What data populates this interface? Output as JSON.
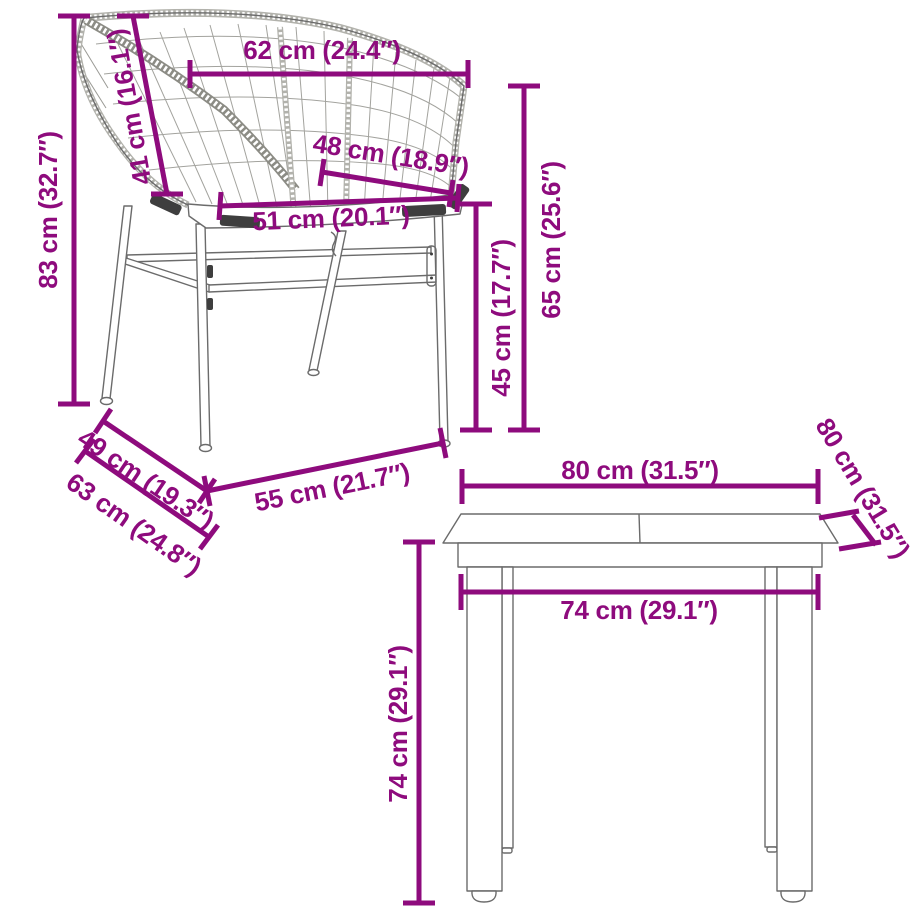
{
  "title": "Garden furniture set dimensions diagram",
  "colors": {
    "dimension": "#8e0b7d",
    "lineart": "#6b6b6b",
    "background": "#ffffff"
  },
  "chair": {
    "name": "garden chair with rattan backrest",
    "dims": {
      "height": "83 cm (32.7″)",
      "back_width": "62 cm (24.4″)",
      "backrest_height": "41 cm (16.1″)",
      "seat_depth": "48 cm (18.9″)",
      "seat_width": "51 cm (20.1″)",
      "armrest_height": "65 cm (25.6″)",
      "seat_height": "45 cm (17.7″)",
      "base_depth": "49 cm (19.3″)",
      "total_depth": "63 cm (24.8″)",
      "front_width": "55 cm (21.7″)"
    }
  },
  "table": {
    "name": "garden table",
    "dims": {
      "top_width": "80 cm (31.5″)",
      "top_depth": "80 cm (31.5″)",
      "leg_span_width": "74 cm (29.1″)",
      "height": "74 cm (29.1″)"
    }
  }
}
